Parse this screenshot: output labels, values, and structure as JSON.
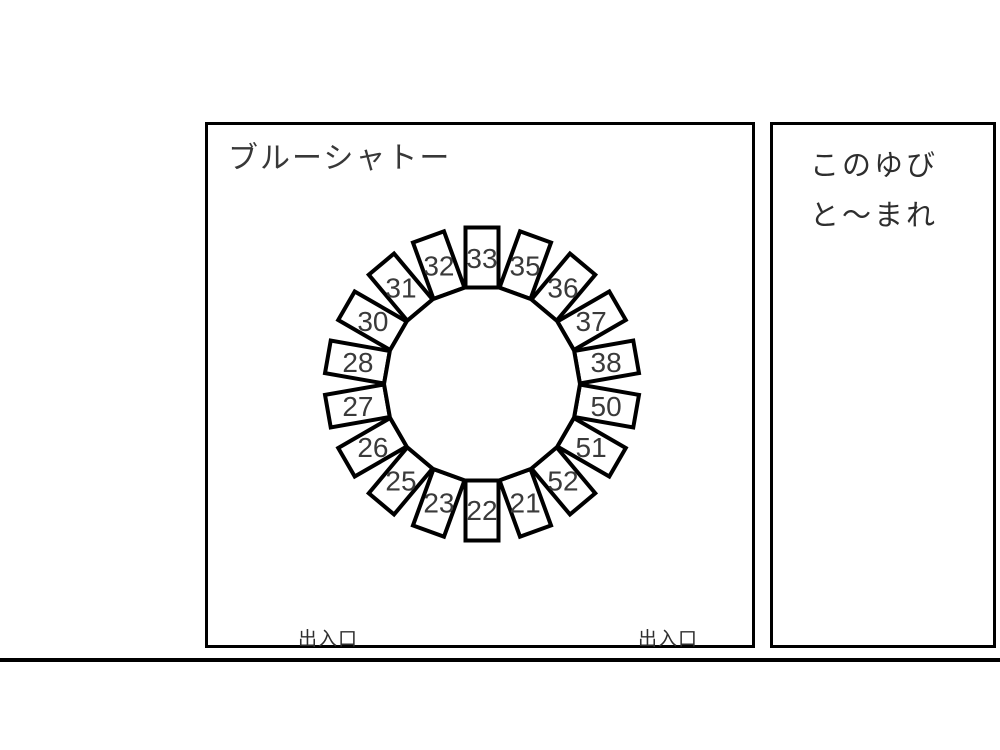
{
  "main_panel": {
    "title": "ブルーシャトー",
    "exit_left_label": "出入口",
    "exit_right_label": "出入口"
  },
  "side_panel": {
    "line1": "このゆび",
    "line2": "と〜まれ"
  },
  "seating": {
    "shape": "circular-table-with-radial-seats",
    "seat_count": 18,
    "seats_clockwise_from_top": [
      "33",
      "35",
      "36",
      "37",
      "38",
      "50",
      "51",
      "52",
      "21",
      "22",
      "23",
      "25",
      "26",
      "27",
      "28",
      "30",
      "31",
      "32"
    ],
    "colors": {
      "outline": "#000000",
      "seat_fill": "#ffffff",
      "table_fill": "#ffffff",
      "number_text": "#3a3a3a"
    }
  }
}
